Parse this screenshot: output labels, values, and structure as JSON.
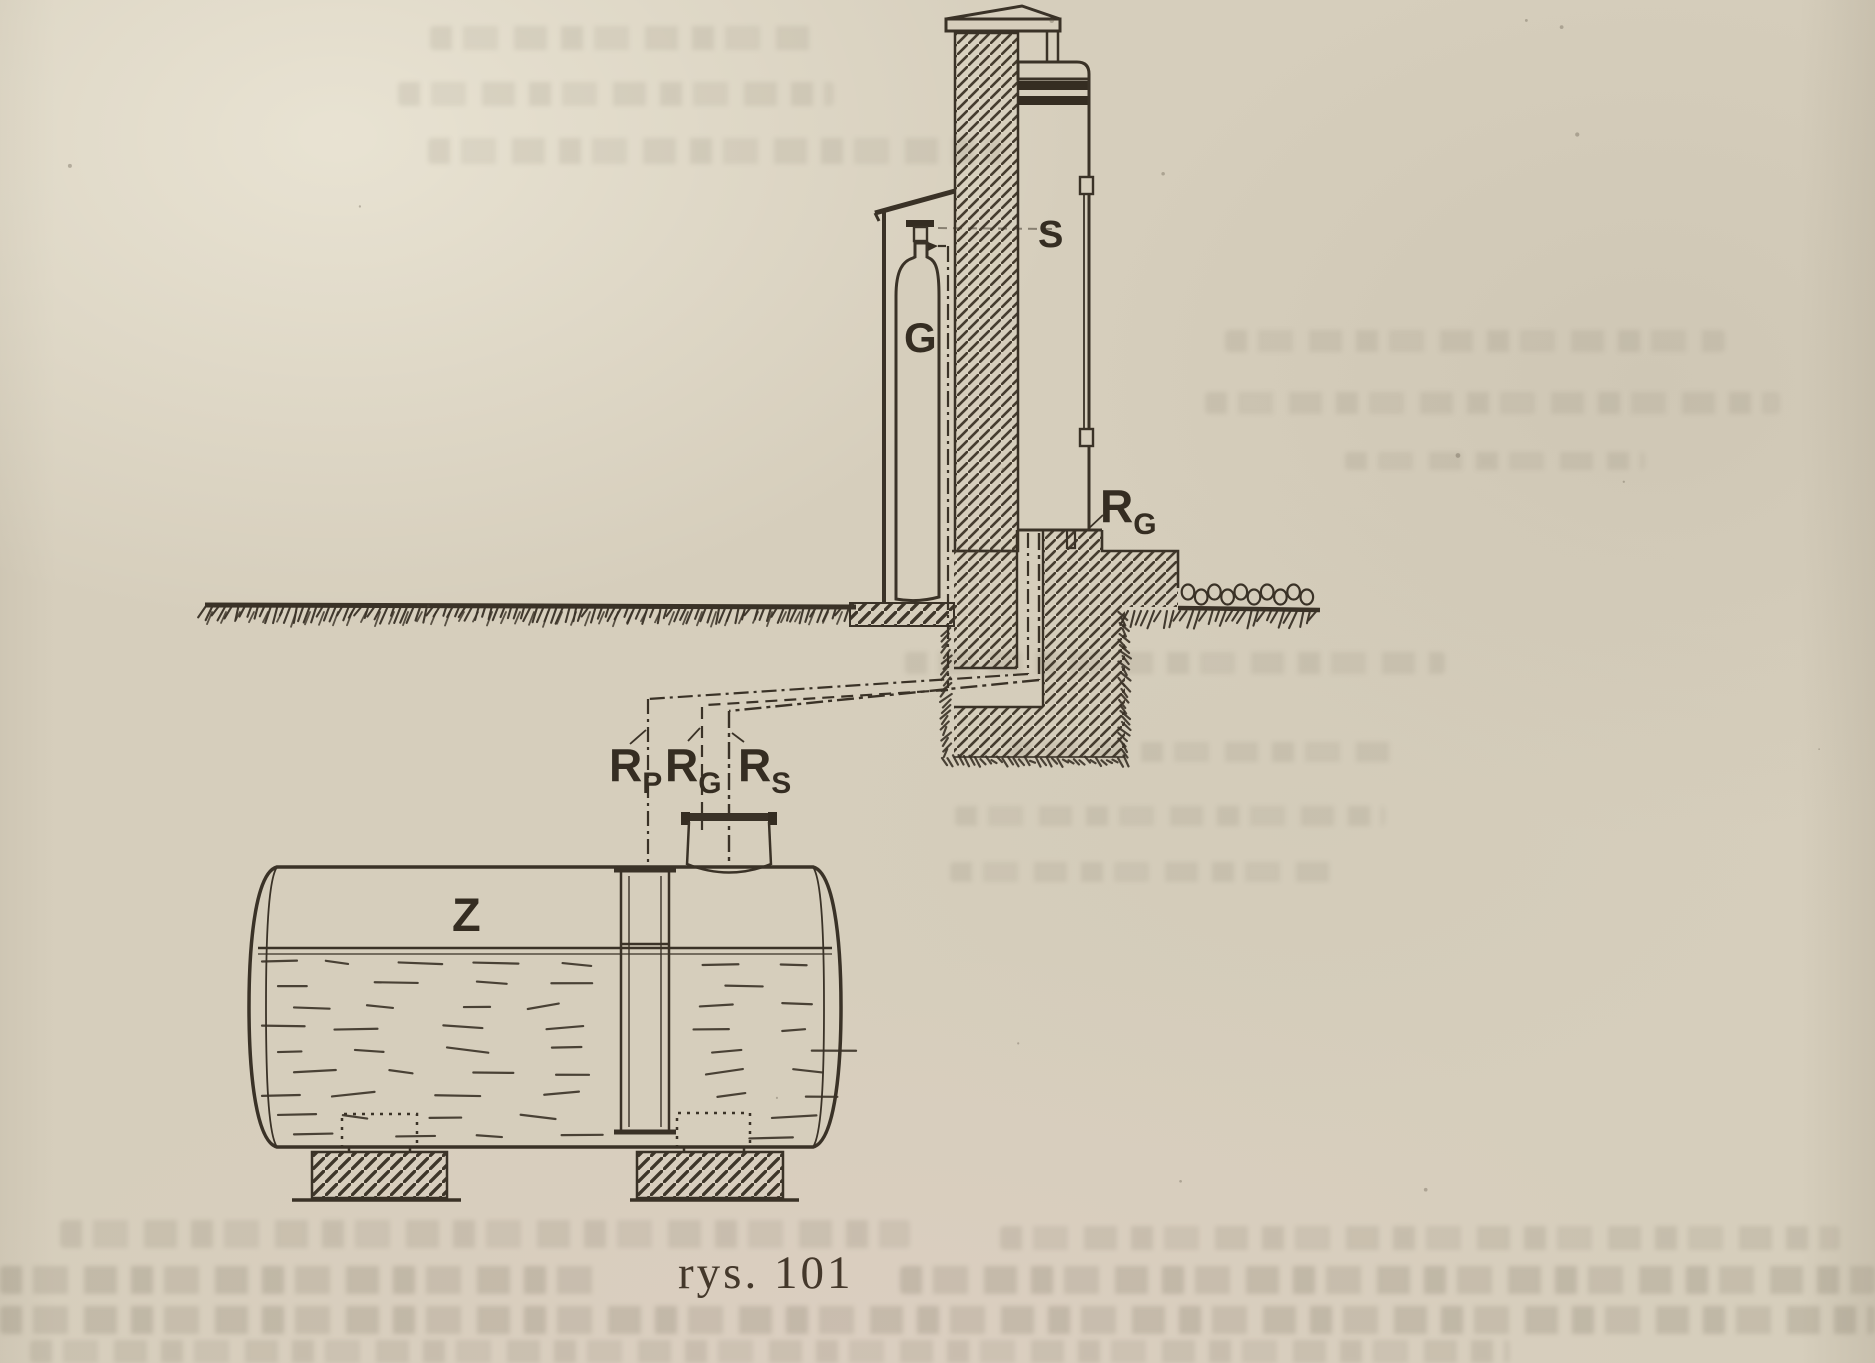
{
  "figure": {
    "caption": "rys. 101",
    "labels": {
      "dispenser": "S",
      "gas_cylinder": "G",
      "tank": "Z",
      "pipe_gas_wall": {
        "main": "R",
        "sub": "G"
      },
      "pipe_gauge": {
        "main": "R",
        "sub": "P"
      },
      "pipe_gas": {
        "main": "R",
        "sub": "G"
      },
      "pipe_suction": {
        "main": "R",
        "sub": "S"
      }
    },
    "colors": {
      "ink": "#3a3227",
      "paper": "#d6cebc"
    }
  }
}
